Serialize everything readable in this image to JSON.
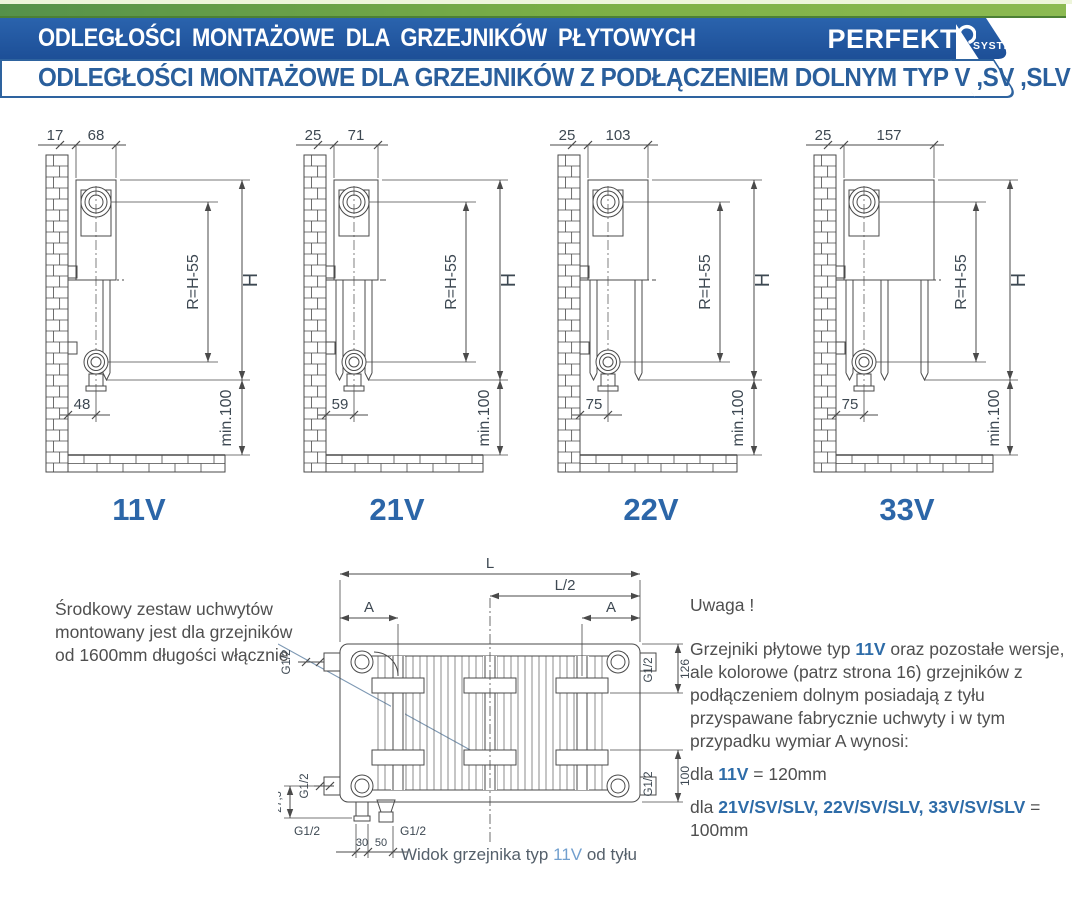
{
  "header": {
    "title": "ODLEGŁOŚCI MONTAŻOWE DLA GRZEJNIKÓW PŁYTOWYCH",
    "logo_text": "PERFEKT",
    "logo_sub": "SYSTEM",
    "subtitle": "ODLEGŁOŚCI MONTAŻOWE DLA GRZEJNIKÓW Z PODŁĄCZENIEM DOLNYM TYP V ,SV ,SLV"
  },
  "diagrams": [
    {
      "type": "11V",
      "wall_gap": "17",
      "depth": "68",
      "pipe_offset": "48",
      "r": "R=H-55",
      "h": "H",
      "min": "min.100"
    },
    {
      "type": "21V",
      "wall_gap": "25",
      "depth": "71",
      "pipe_offset": "59",
      "r": "R=H-55",
      "h": "H",
      "min": "min.100"
    },
    {
      "type": "22V",
      "wall_gap": "25",
      "depth": "103",
      "pipe_offset": "75",
      "r": "R=H-55",
      "h": "H",
      "min": "min.100"
    },
    {
      "type": "33V",
      "wall_gap": "25",
      "depth": "157",
      "pipe_offset": "75",
      "r": "R=H-55",
      "h": "H",
      "min": "min.100"
    }
  ],
  "rear": {
    "l": "L",
    "l2": "L/2",
    "a": "A",
    "g12": "G1/2",
    "d126": "126",
    "d100": "100",
    "d275": "27,5",
    "d30": "30",
    "d50": "50",
    "caption_prefix": "Widok grzejnika typ ",
    "caption_type": "11V",
    "caption_suffix": " od tyłu"
  },
  "notes": {
    "left": "Środkowy zestaw uchwytów montowany jest dla grzejników od 1600mm długości włącznie",
    "uwaga": "Uwaga !",
    "para_1": "Grzejniki płytowe typ ",
    "para_bold1": "11V",
    "para_2": " oraz pozostałe wersje, ale kolorowe (patrz strona 16) grzejników z podłączeniem dolnym posiadają z tyłu przyspawane fabrycznie uchwyty i w tym przypadku wymiar A wynosi:",
    "dla1_pre": "dla ",
    "dla1_bold": "11V",
    "dla1_post": " = 120mm",
    "dla2_pre": "dla ",
    "dla2_bold": "21V/SV/SLV, 22V/SV/SLV, 33V/SV/SLV",
    "dla2_post": " = 100mm"
  },
  "colors": {
    "banner_blue": "#2158a5",
    "band_green": "#7cb045",
    "accent_blue": "#2c66a8",
    "caption_blue": "#719fce",
    "leader": "#7d98b3"
  }
}
